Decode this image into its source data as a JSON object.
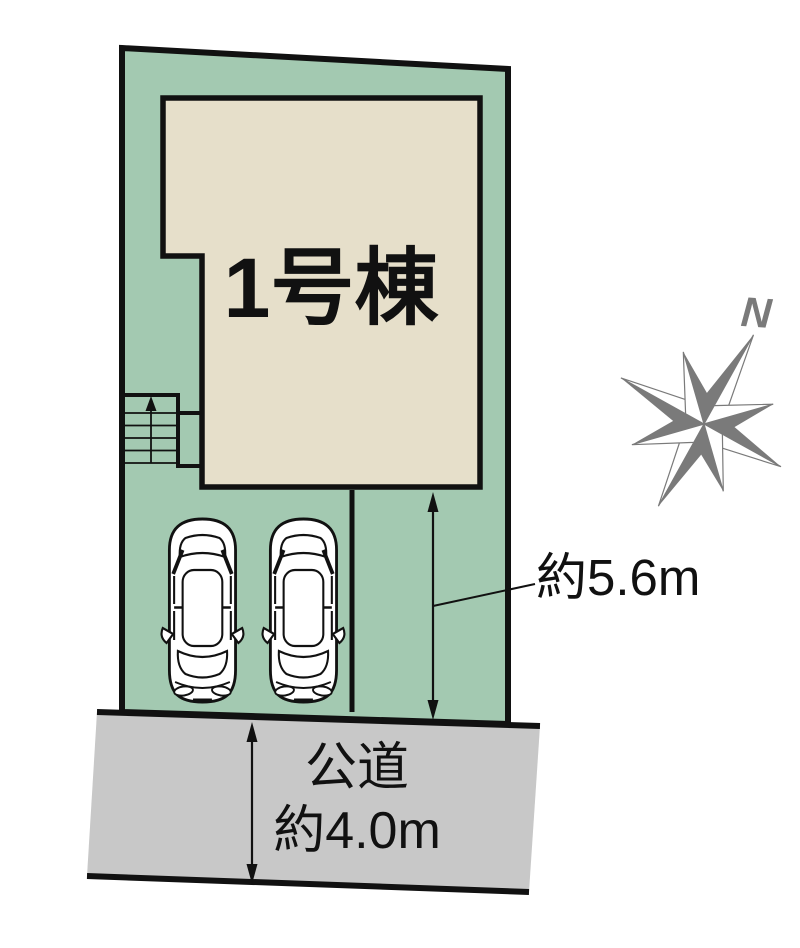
{
  "page": {
    "background": "#ffffff"
  },
  "colors": {
    "lot_fill": "#a3c9b1",
    "building_fill": "#e6dfca",
    "road_fill": "#c8c8c8",
    "outline": "#111111",
    "compass_gray": "#7a7a7a",
    "label_text": "#111111"
  },
  "site_plan": {
    "building_label": "1号棟",
    "depth_dimension": "約5.6m",
    "road_name": "公道",
    "road_width": "約4.0m",
    "compass_north": "N"
  },
  "icons": {
    "compass": "compass-rose-icon",
    "stairs": "stairs-icon",
    "cars": "car-top-view-icon",
    "dimensions": "double-arrow-icon"
  }
}
